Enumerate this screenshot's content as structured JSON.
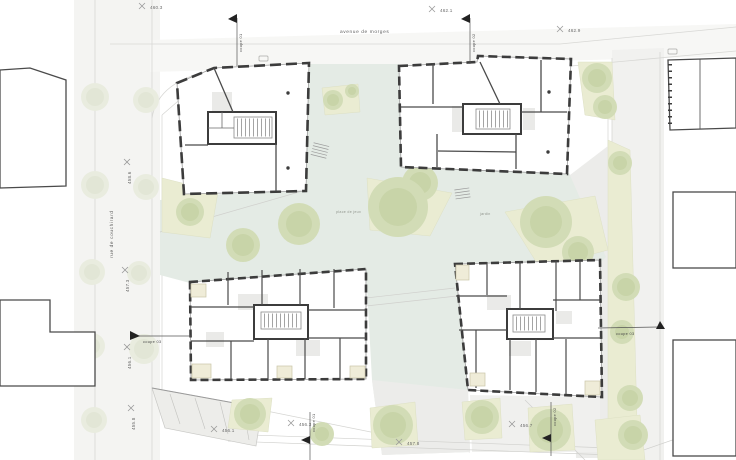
{
  "drawing": {
    "type": "architectural-site-plan",
    "streets": {
      "top": "avenue de morges",
      "left": "rue de couchirard"
    },
    "elevations": [
      {
        "v": "460.3"
      },
      {
        "v": "462.1"
      },
      {
        "v": "462.9"
      },
      {
        "v": "458.6"
      },
      {
        "v": "457.3"
      },
      {
        "v": "456.1"
      },
      {
        "v": "455.8"
      },
      {
        "v": "456.1"
      },
      {
        "v": "456.3"
      },
      {
        "v": "457.8"
      },
      {
        "v": "456.7"
      }
    ],
    "sections": [
      {
        "label": "coupe 01"
      },
      {
        "label": "coupe 02"
      },
      {
        "label": "coupe 03"
      },
      {
        "label": "coupe 01"
      },
      {
        "label": "coupe 02"
      },
      {
        "label": "coupe 03"
      }
    ],
    "areas": [
      {
        "label": "place de jeux"
      },
      {
        "label": "jardin"
      }
    ],
    "colors": {
      "plaza": "#e4ebe5",
      "planting": "#eaecd2",
      "tree": "#d2dcb6",
      "street_tree": "#e9ecdf",
      "wall": "#3c3c3c",
      "paving": "#ececea",
      "balcony": "#efecd8"
    }
  }
}
